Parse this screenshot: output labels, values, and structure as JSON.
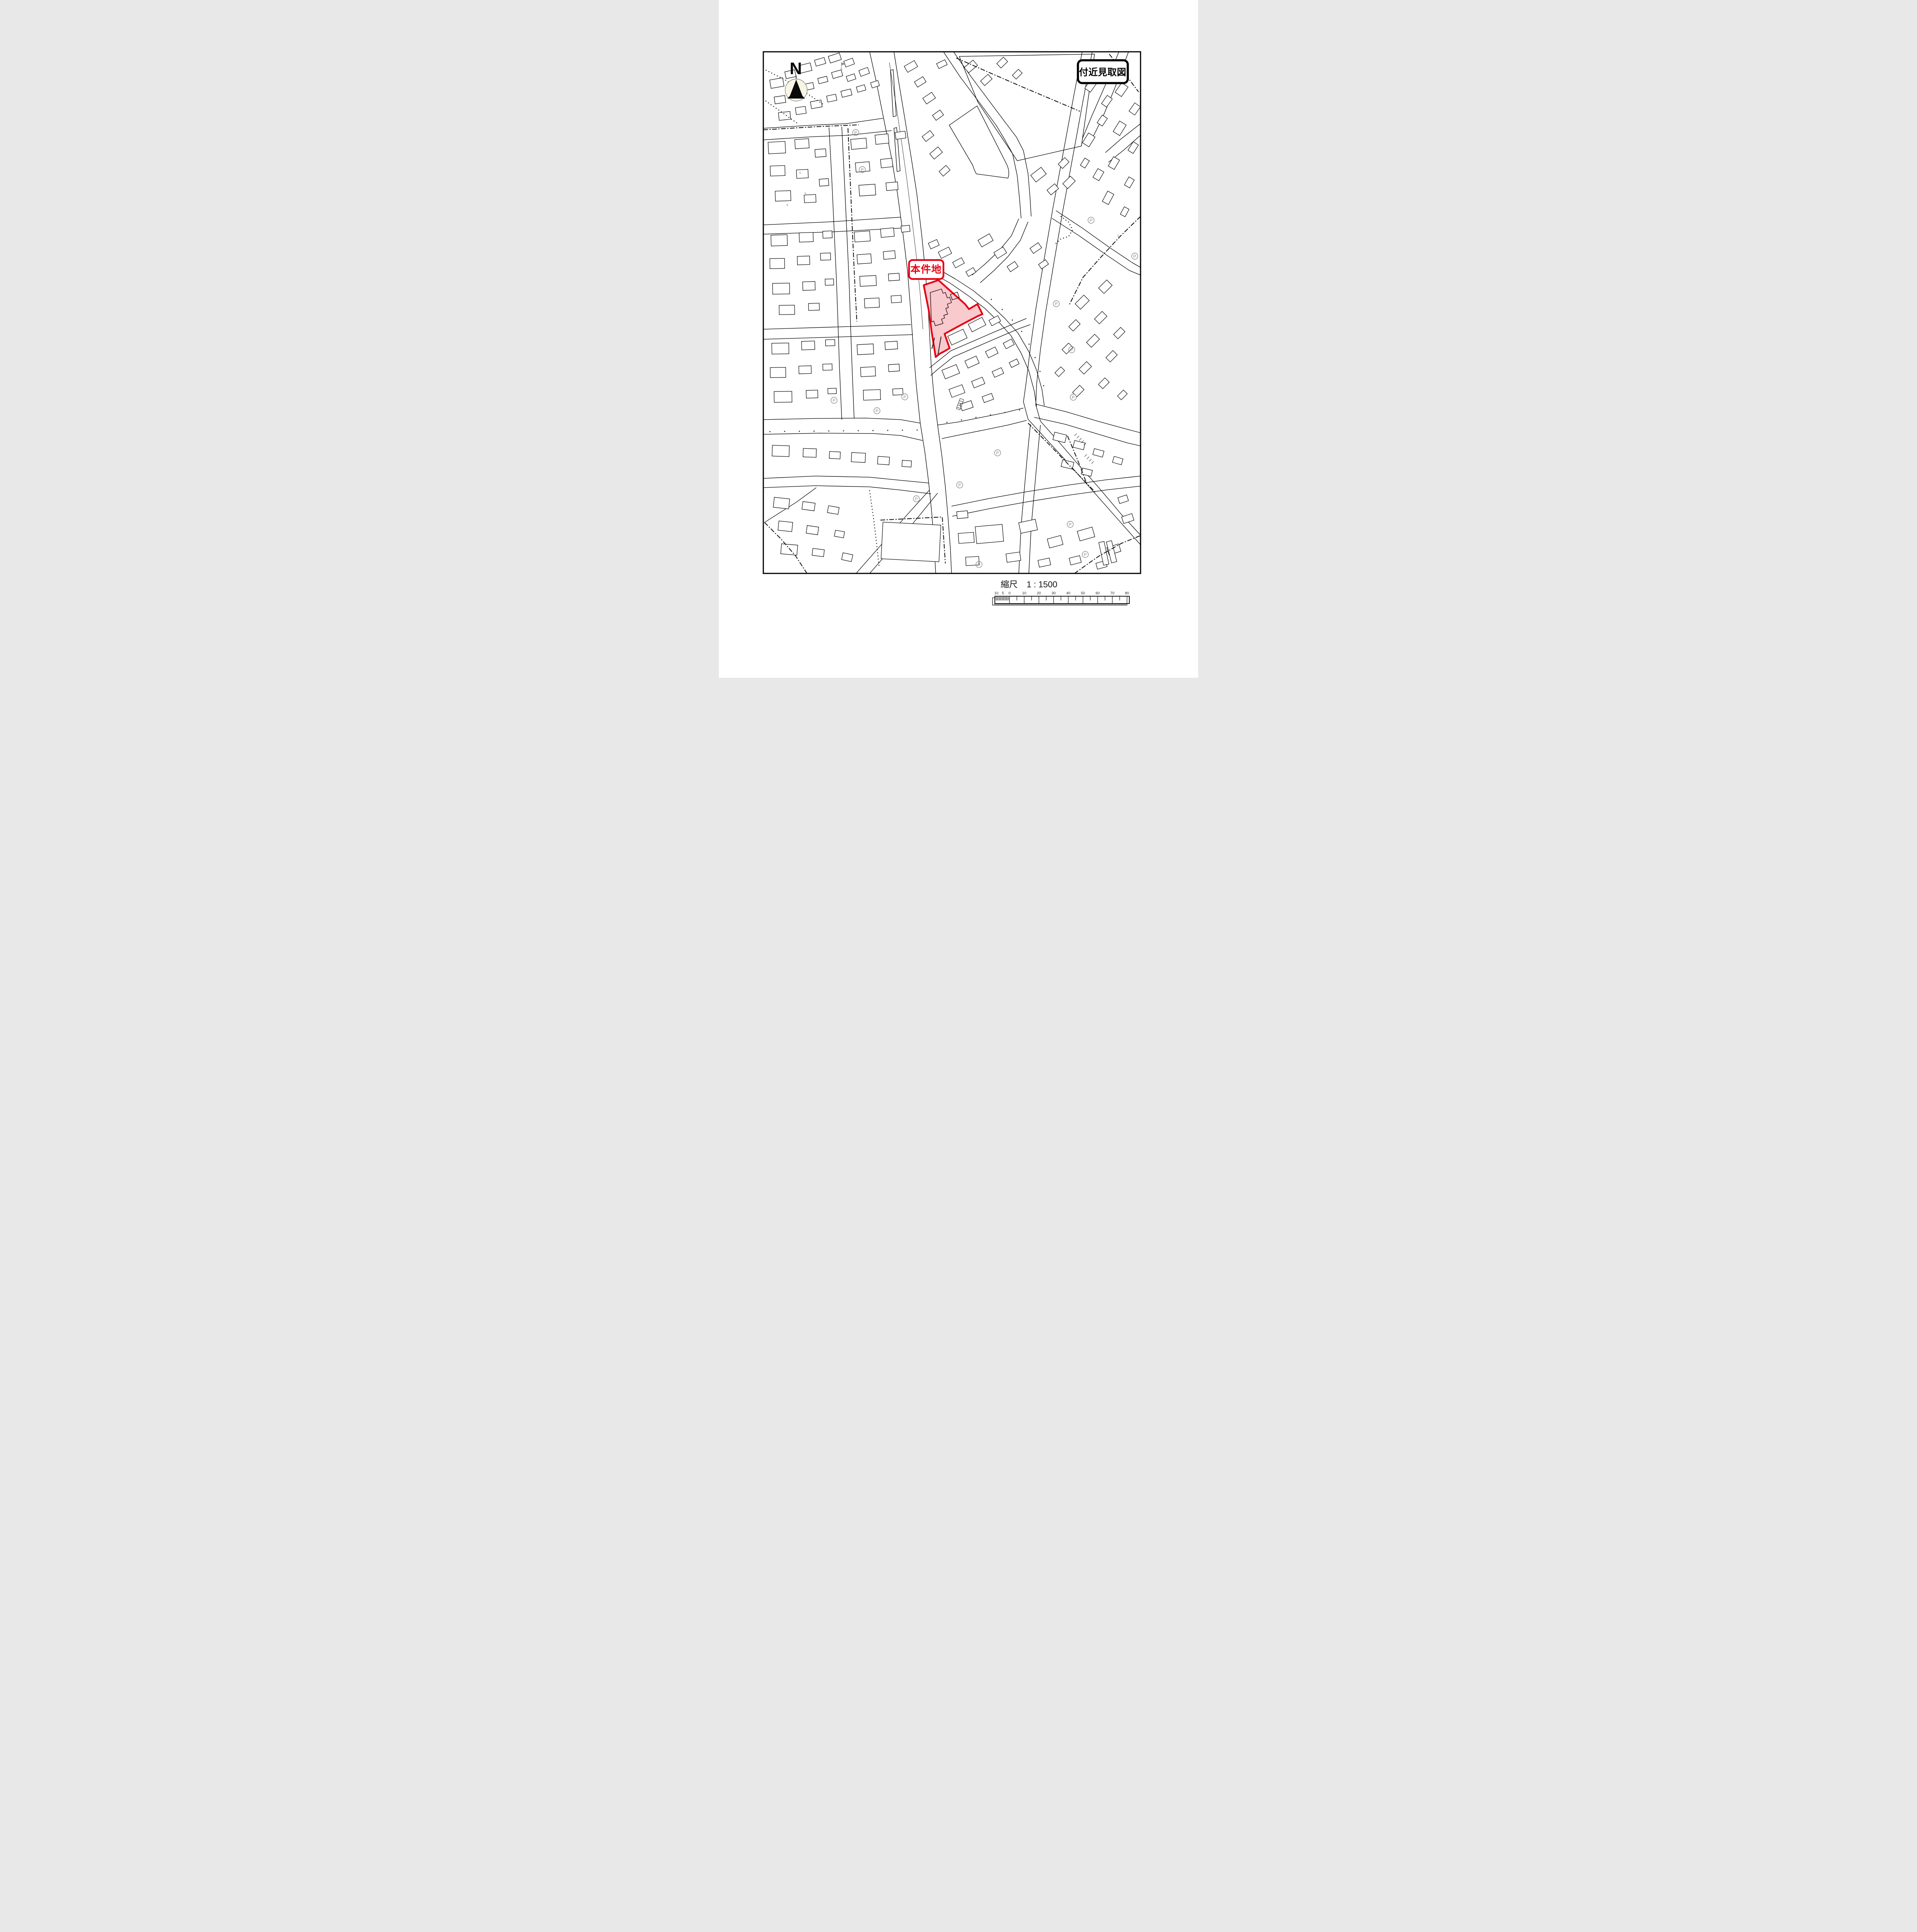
{
  "document": {
    "type_label": "付近見取図"
  },
  "north": {
    "label": "N"
  },
  "site": {
    "label": "本件地"
  },
  "scale": {
    "prefix": "縮尺",
    "ratio": "1 : 1500",
    "bar_labels": [
      "10",
      "5",
      "0",
      "10",
      "20",
      "30",
      "40",
      "50",
      "60",
      "70",
      "80"
    ]
  },
  "symbols": {
    "parking": "P",
    "check": "∨"
  },
  "colors": {
    "map_line": "#000000",
    "site_outline": "#e60012",
    "site_fill": "#f8c9cd",
    "muted_symbol": "#8c8c8c"
  }
}
